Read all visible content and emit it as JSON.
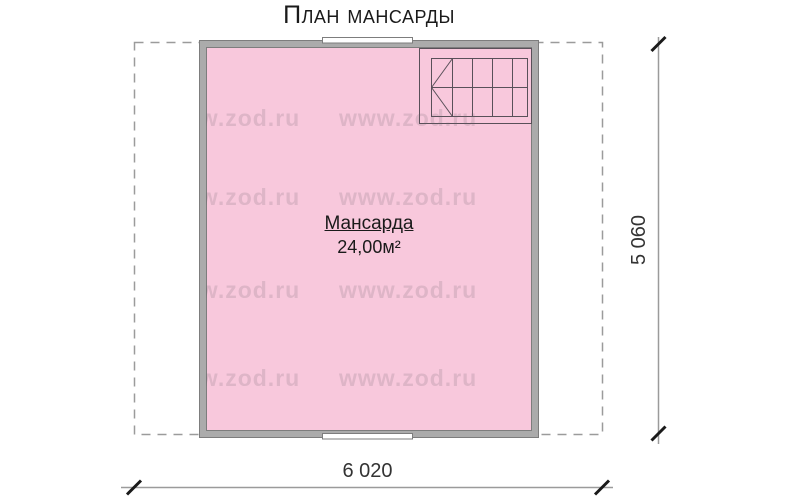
{
  "title": "План мансарды",
  "room": {
    "name": "Мансарда",
    "area": "24,00м²"
  },
  "dimensions": {
    "width": "6 020",
    "height": "5 060"
  },
  "watermark": "www.zod.ru",
  "colors": {
    "room_fill": "#f8c8dc",
    "wall_fill": "#ababab",
    "wall_edge": "#7d7d7d",
    "roof_dashed_line": "#9b9b9b",
    "dimension_line": "#9b9b9b",
    "dimension_tick": "#1a1a1a",
    "stair_line": "#595059",
    "text": "#1a1a1a"
  }
}
